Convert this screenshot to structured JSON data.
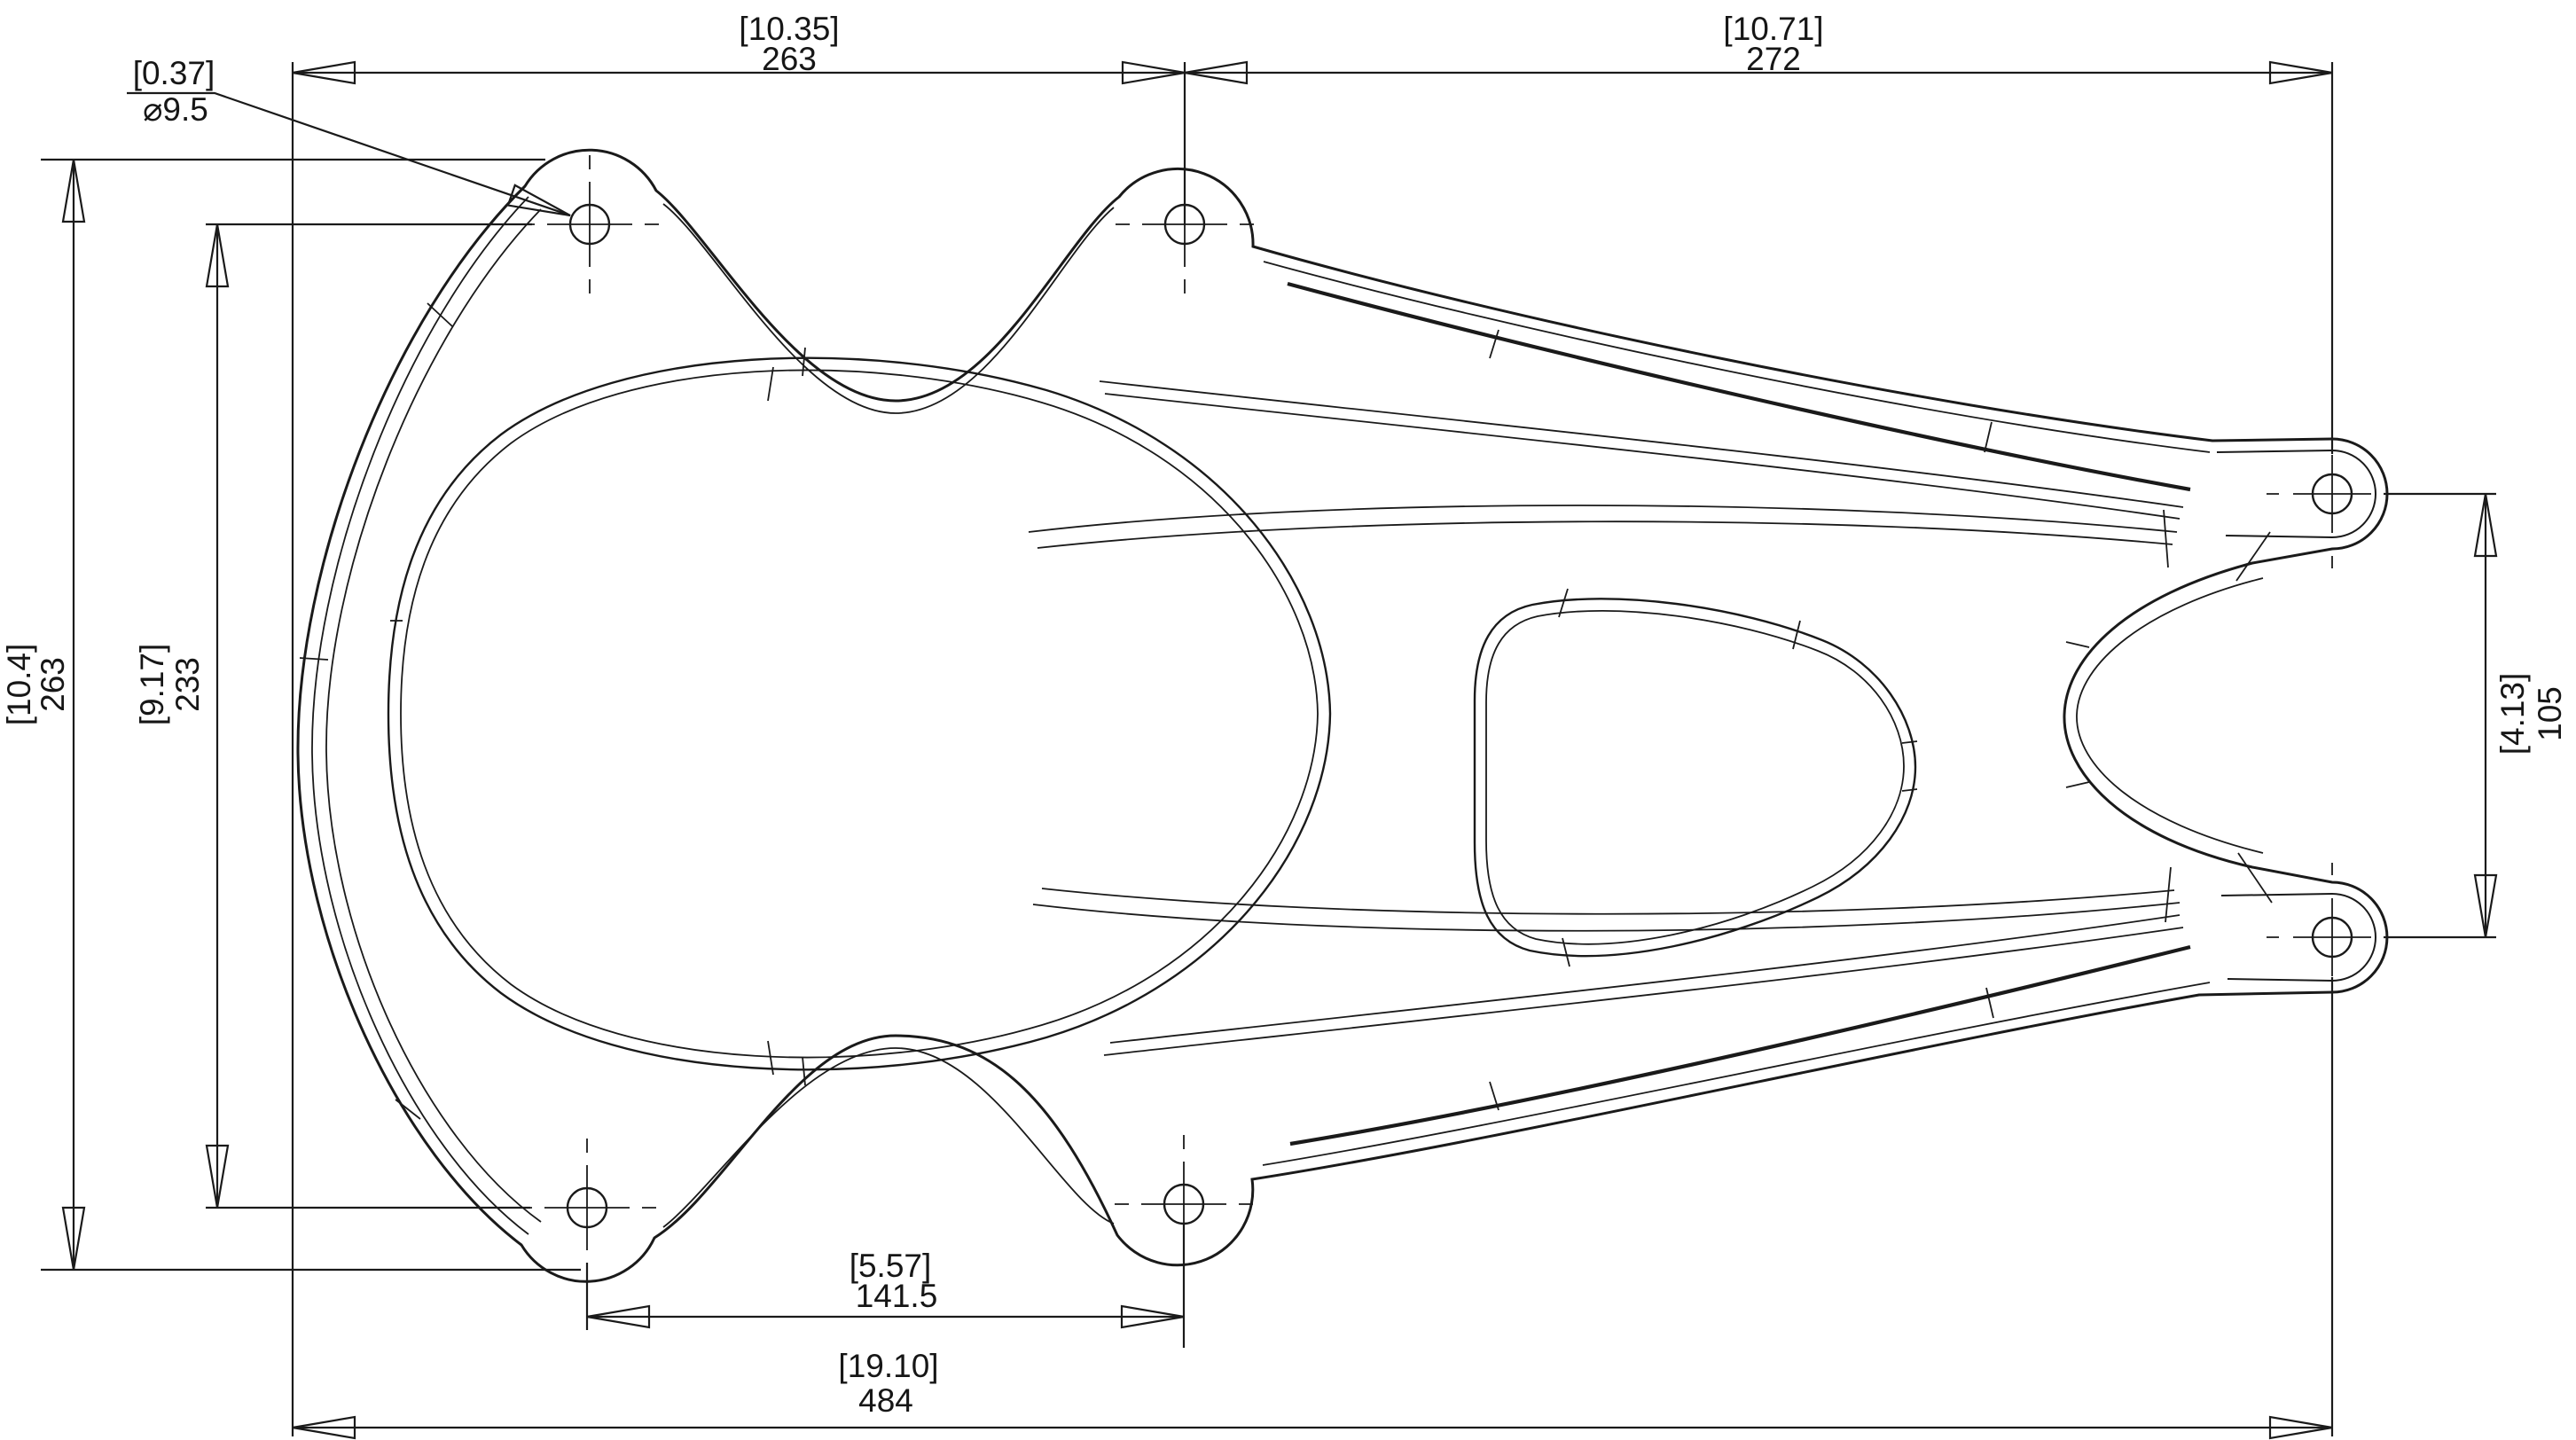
{
  "drawing": {
    "type": "2D dimensioned part drawing, top view",
    "background_color": "#ffffff",
    "line_color": "#1a1a1a",
    "dimensions": {
      "top_left": {
        "ref": "[10.35]",
        "val": "263"
      },
      "top_right": {
        "ref": "[10.71]",
        "val": "272"
      },
      "hole_callout": {
        "ref": "[0.37]",
        "val": "⌀9.5"
      },
      "left_overall": {
        "ref": "[10.4]",
        "val": "263"
      },
      "left_holes": {
        "ref": "[9.17]",
        "val": "233"
      },
      "right_pivots": {
        "ref": "[4.13]",
        "val": "105"
      },
      "bottom_holes": {
        "ref": "[5.57]",
        "val": "141.5"
      },
      "bottom_overall": {
        "ref": "[19.10]",
        "val": "484"
      }
    }
  }
}
